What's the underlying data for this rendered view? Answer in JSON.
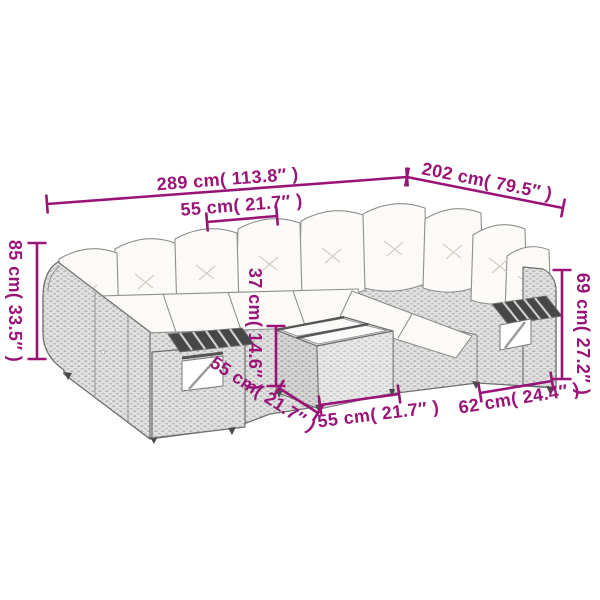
{
  "meta": {
    "type": "product-dimension-diagram",
    "subject": "gray poly rattan garden corner sofa set with cushions, shelf arm modules and coffee table"
  },
  "style": {
    "accent": "#9A1478",
    "background": "#ffffff",
    "wicker_base": "#e2e2e2",
    "wicker_dot": "#b4b4b4",
    "outline": "#6f6f6f",
    "cushion": "#fbfaf6",
    "slat_dark": "#454545"
  },
  "dimensions": [
    {
      "id": "sofa-length",
      "label": "289 cm( 113.8″ )",
      "x1": 47,
      "y1": 204,
      "x2": 407,
      "y2": 177,
      "lx": 228,
      "ly": 185,
      "rot": -4.3
    },
    {
      "id": "sofa-side-length",
      "label": "202 cm( 79.5″ )",
      "x1": 407,
      "y1": 177,
      "x2": 563,
      "y2": 208,
      "lx": 486,
      "ly": 187,
      "rot": 11.2
    },
    {
      "id": "cushion-width",
      "label": "55 cm( 21.7″ )",
      "x1": 207,
      "y1": 222,
      "x2": 277,
      "y2": 216,
      "lx": 242,
      "ly": 211,
      "rot": -4.5
    },
    {
      "id": "back-height",
      "label": "85 cm( 33.5″ )",
      "x1": 37,
      "y1": 243,
      "x2": 37,
      "y2": 359,
      "lx": 9,
      "ly": 301,
      "rot": 90
    },
    {
      "id": "table-height",
      "label": "37 cm( 14.6″ )",
      "x1": 276,
      "y1": 326,
      "x2": 276,
      "y2": 386,
      "lx": 249,
      "ly": 329,
      "rot": 90
    },
    {
      "id": "table-depth",
      "label": "55 cm( 21.7″ )",
      "x1": 279,
      "y1": 388,
      "x2": 318,
      "y2": 413,
      "lx": 260,
      "ly": 399,
      "rot": 33
    },
    {
      "id": "table-width",
      "label": "55 cm( 21.7″ )",
      "x1": 320,
      "y1": 405,
      "x2": 399,
      "y2": 394,
      "lx": 379,
      "ly": 420,
      "rot": -7
    },
    {
      "id": "seat-depth",
      "label": "62 cm( 24.4″ )",
      "x1": 480,
      "y1": 393,
      "x2": 552,
      "y2": 381,
      "lx": 520,
      "ly": 404,
      "rot": -9
    },
    {
      "id": "arm-height",
      "label": "69 cm( 27.2″ )",
      "x1": 562,
      "y1": 270,
      "x2": 562,
      "y2": 379,
      "lx": 577,
      "ly": 334,
      "rot": 90
    }
  ]
}
